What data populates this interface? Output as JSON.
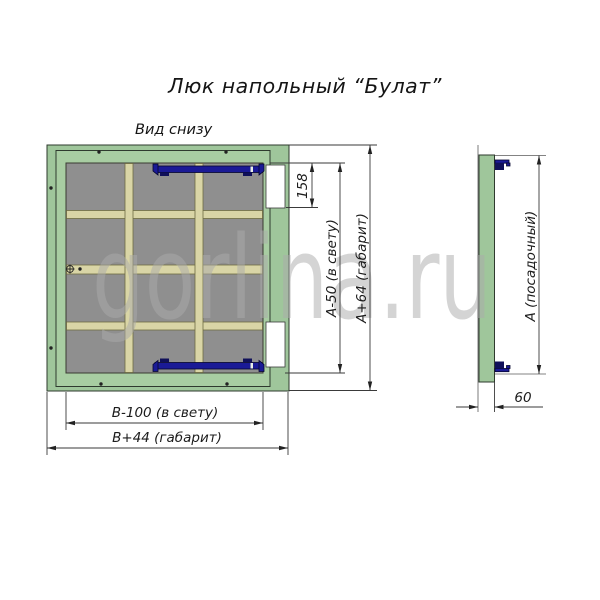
{
  "title": "Люк напольный “Булат”",
  "view_label": "Вид снизу",
  "watermark": "gorlina.ru",
  "plan_view": {
    "dim_158": "158",
    "dim_height_clear": "А-50 (в свету)",
    "dim_height_overall": "А+64 (габарит)",
    "dim_width_clear": "В-100 (в свету)",
    "dim_width_overall": "В+44 (габарит)"
  },
  "side_view": {
    "dim_seat": "А (посадочный)",
    "dim_depth": "60"
  },
  "colors": {
    "frame_green": "#9fc69b",
    "lid_green": "#a8cda2",
    "panel_gray": "#8f8f8f",
    "rib_tan": "#d9d5a6",
    "latch_navy": "#1a1a96",
    "dimension_line": "#3a3a3a",
    "watermark_gray": "#ababab"
  }
}
